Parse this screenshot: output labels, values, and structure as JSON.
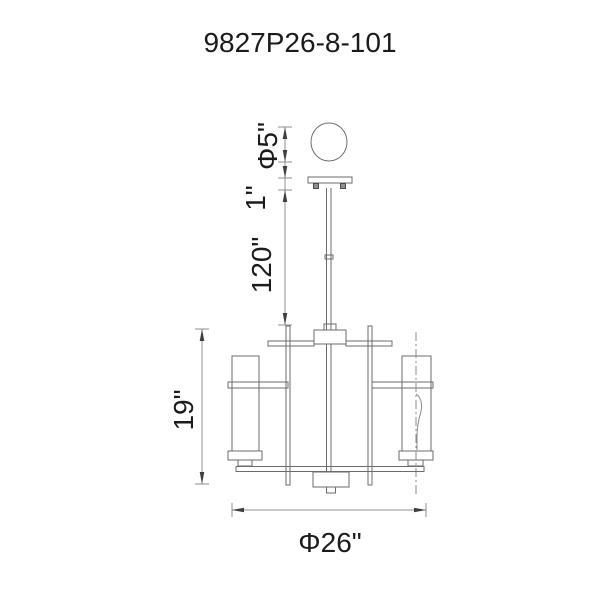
{
  "title": "9827P26-8-101",
  "drawing": {
    "type": "technical-dimension-drawing",
    "subject": "linear chandelier with down rod, canopy ball and two cylindrical shades",
    "dimensions": {
      "ball_diameter": "Φ5\"",
      "canopy_height": "1\"",
      "rod_drop": "120\"",
      "body_height": "19\"",
      "body_diameter": "Φ26\""
    },
    "colors": {
      "background": "#ffffff",
      "line": "#6b6b6b",
      "dimension_line": "#8f8f8f",
      "arrow": "#3f3f3f",
      "text": "#1b1b1b"
    }
  }
}
